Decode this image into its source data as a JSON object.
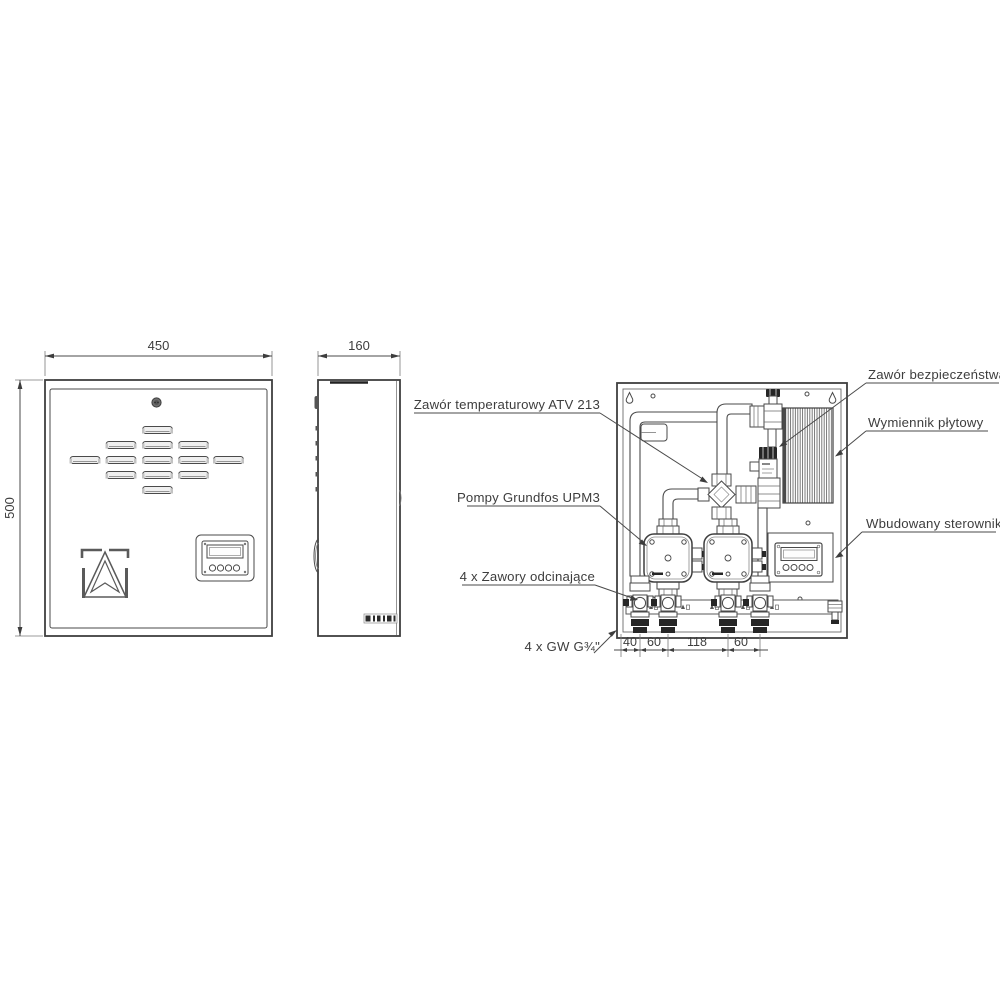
{
  "dimensions": {
    "front_width": "450",
    "front_height": "500",
    "side_depth": "160",
    "bottom_spacings": [
      "40",
      "60",
      "118",
      "60"
    ]
  },
  "labels": {
    "temperature_valve": "Zawór temperaturowy ATV 213",
    "pumps": "Pompy Grundfos UPM3",
    "shutoff_valves": "4 x Zawory odcinające",
    "thread_connections": "4 x GW G¾\"",
    "safety_valve": "Zawór bezpieczeństwa",
    "heat_exchanger": "Wymiennik płytowy",
    "controller": "Wbudowany sterownik"
  },
  "colors": {
    "line": "#3d3d3d",
    "dark_fill": "#262626",
    "background": "#ffffff"
  }
}
